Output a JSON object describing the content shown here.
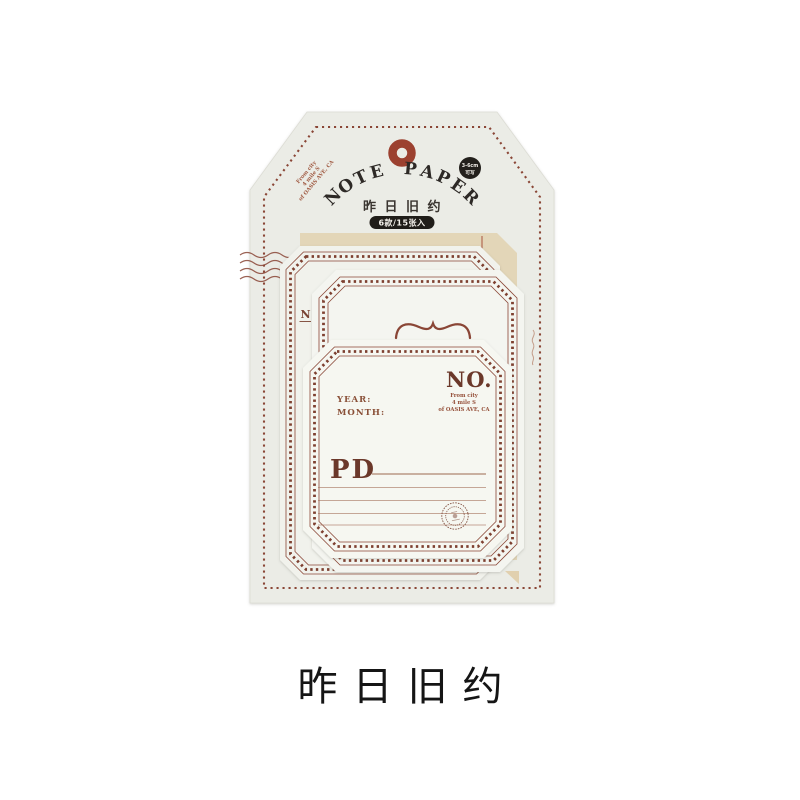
{
  "product": {
    "package": {
      "title": "NOTE PAPER",
      "subtitle": "昨日旧约",
      "count_badge": "6款/15张入",
      "round_badge_line1": "3-6cm",
      "round_badge_line2": "可写",
      "corner_stamp_line1": "From city",
      "corner_stamp_line2": "4 mile S",
      "corner_stamp_line3": "of OASIS AVE, CA"
    },
    "cards": {
      "back_letter": "N",
      "front": {
        "year": "YEAR:",
        "month": "MONTH:",
        "no": "NO.",
        "no_sub_line1": "From city",
        "no_sub_line2": "4 mile S",
        "no_sub_line3": "of OASIS AVE, CA",
        "pd": "PD"
      }
    }
  },
  "caption": "昨日旧约",
  "colors": {
    "accent_brown": "#8a4636",
    "hole_red": "#9c4130",
    "badge_black": "#211e1b",
    "tag_paper": "#ebece6",
    "card_paper": "#f5f6f1",
    "kraft": "#e3d6b8",
    "caption_black": "#151515"
  }
}
